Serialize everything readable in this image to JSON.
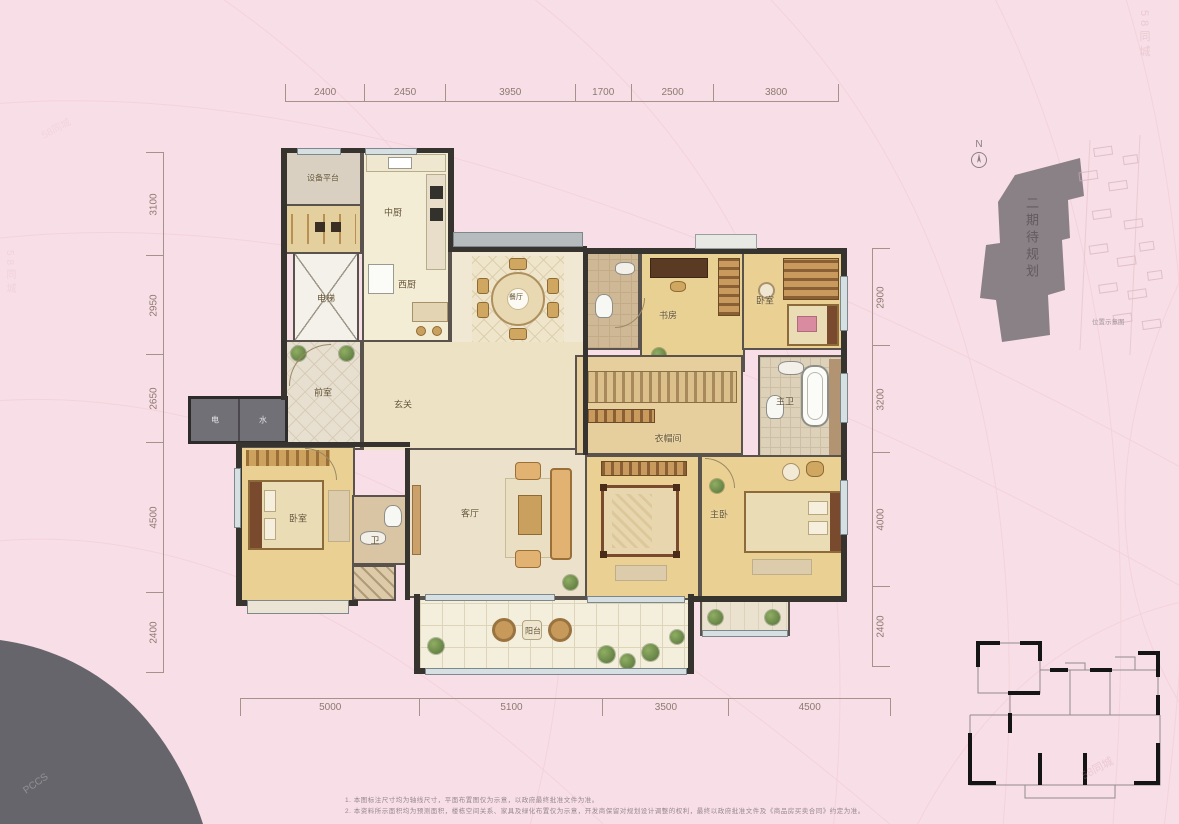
{
  "dimensions": {
    "top": [
      "2400",
      "2450",
      "3950",
      "1700",
      "2500",
      "3800"
    ],
    "left": [
      "3100",
      "2950",
      "2650",
      "4500",
      "2400"
    ],
    "right": [
      "2900",
      "3200",
      "4000",
      "2400"
    ],
    "bottom": [
      "5000",
      "5100",
      "3500",
      "4500"
    ]
  },
  "rooms": {
    "equipment_platform": "设备平台",
    "kitchen": "中厨",
    "west_kitchen": "西厨",
    "elevator": "电梯",
    "lobby": "前室",
    "meter_electric": "电",
    "meter_water": "水",
    "foyer": "玄关",
    "dining": "餐厅",
    "living_room": "客厅",
    "balcony": "阳台",
    "bedroom_left": "卧室",
    "bath_small": "卫",
    "study": "书房",
    "bedroom_top": "卧室",
    "master_bath": "主卫",
    "cloakroom": "衣帽间",
    "master_bedroom": "主卧"
  },
  "north": {
    "label": "N"
  },
  "site_plan": {
    "phase_label": "二期待规划",
    "caption": "位置示意图"
  },
  "notes": {
    "line1": "1. 本图标注尺寸均为轴线尺寸，平面布置图仅为示意，以政府最终批准文件为准。",
    "line2": "2. 本资料所示面积均为预测面积，楼栋空间关系、家具及绿化布置仅为示意，开发商保留对规划设计调整的权利，最终以政府批准文件及《商品房买卖合同》约定为准。"
  },
  "watermark": {
    "brand": "58同城",
    "corner": "PCCS"
  }
}
